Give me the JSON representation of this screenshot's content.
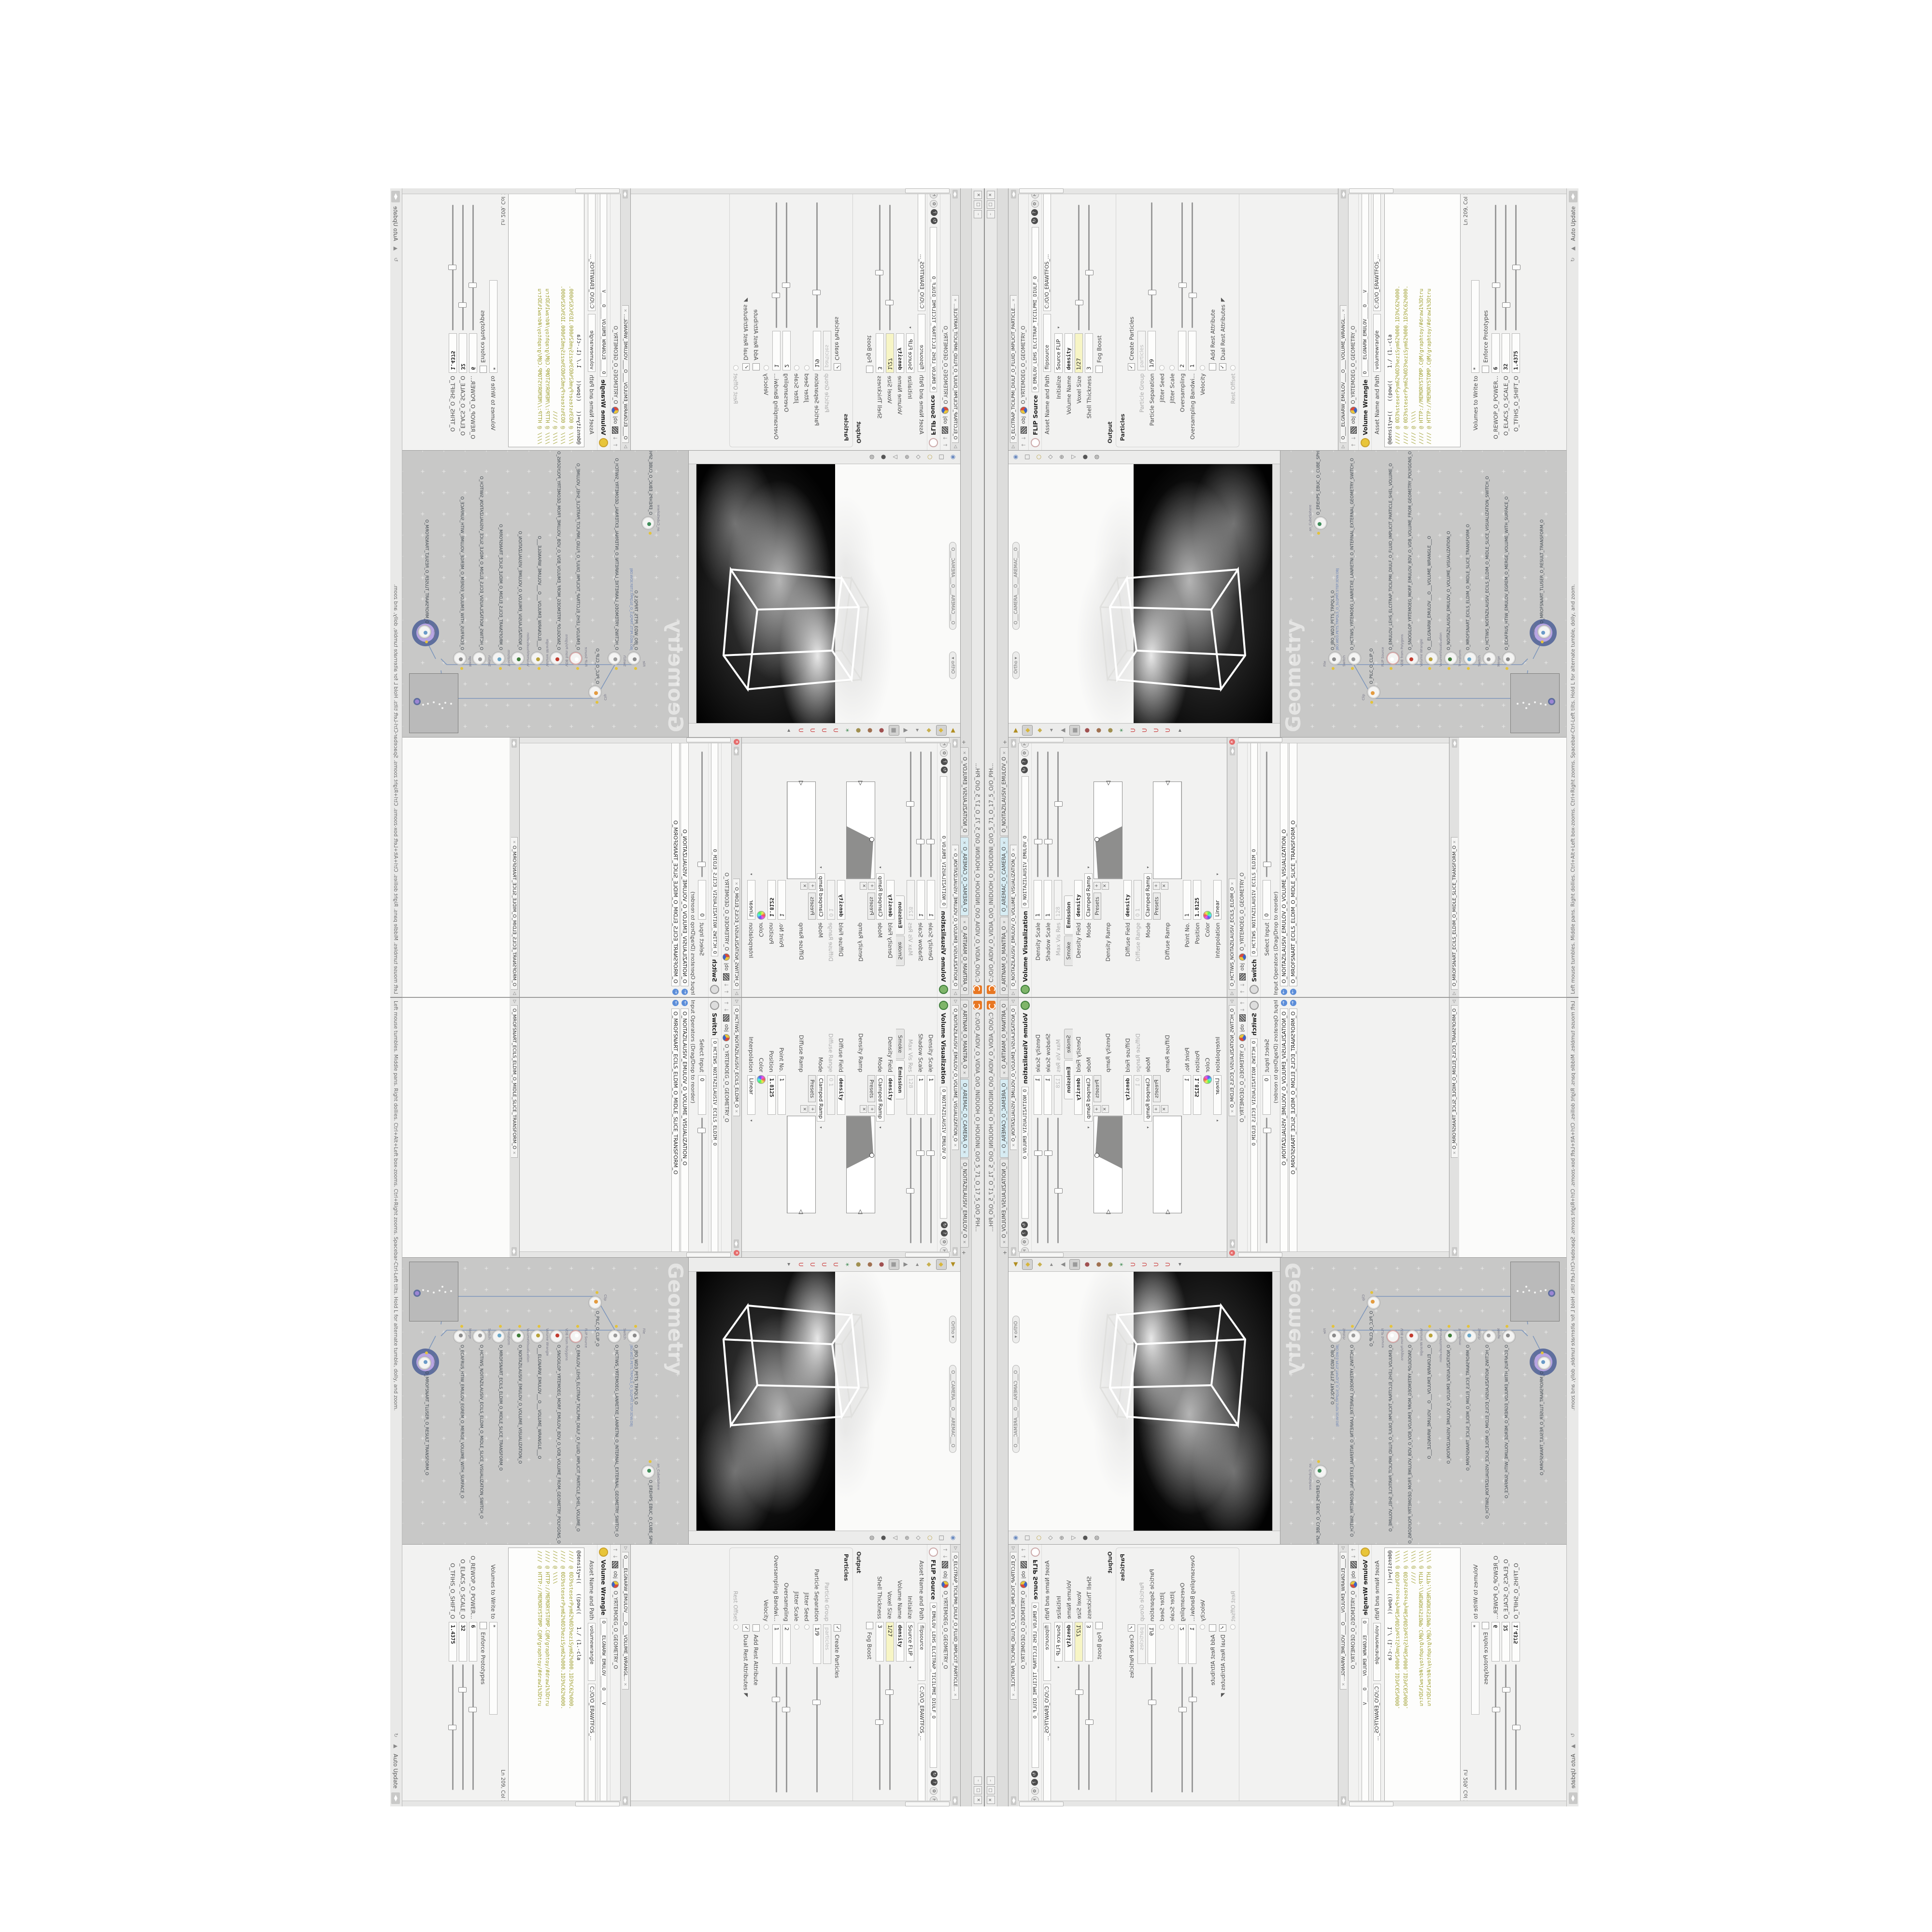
{
  "window": {
    "title": "C:/O/O_AIDIV_O_VIDIA_O/O_INIDUOH_O_HOUDINI_O/O_5_71_O_17_5_O/O_PIH...",
    "logo": "houdini-logo",
    "buttons": [
      "–",
      "□",
      "✕"
    ],
    "tabs": [
      {
        "label": "O_ARTNAM_O_MANTRA_O",
        "active": false
      },
      {
        "label": "O_AREMAC_O_CAMERA_O",
        "active": true
      },
      {
        "label": "O_NOITAZILAUSIV_EMULOV_O",
        "active": false
      }
    ],
    "tab_add": "+",
    "status": {
      "hint": "Left mouse tumbles. Middle pans. Right dollies. Ctrl+Alt+Left box-zooms. Ctrl+Right zooms. Spacebar-Ctrl-Left tilts. Hold L for alternate tumble, dolly, and zoom.",
      "auto_update": "Auto Update"
    }
  },
  "colors": {
    "accent_orange": "#e87722",
    "yellow_field": "#f7f5c5",
    "active_tab_cyan": "#d7ecf3",
    "selection_halo_outer": "#5f6f9e",
    "selection_halo_inner": "#b9a5e3",
    "wire_blue": "#7d96bb",
    "network_bg": "#c8c8c7",
    "code_comment_olive": "#a0a032",
    "code_keyword_blue": "#3a6fae"
  },
  "panes": {
    "flip": {
      "tab": "O_ELCITRAP_TICILPMI_DIULF_O_FLUID_IMPLICIT_PARTICLE...",
      "title": "FLIP Source",
      "name": "O_EMULOV_LEHS_ELCITRAP_TICILPMI_DIULF_O",
      "crumb_root": "obj",
      "crumb_path": "O_YRTEMOEG_O_GEOMETRY_O",
      "asset_label": "Asset Name and Path",
      "asset_value": "flipsource",
      "asset_path": "C:/O/O_ERAWTFOS_...",
      "rows": [
        {
          "type": "menu",
          "label": "Initialize",
          "value": "Source FLIP"
        },
        {
          "type": "field",
          "label": "Volume Name",
          "value": "density",
          "mono": true
        },
        {
          "type": "slider",
          "label": "Voxel Size",
          "value": "1/27",
          "yellow": true,
          "pos": 20
        },
        {
          "type": "slider",
          "label": "Shell Thickness",
          "value": "3",
          "pos": 44
        },
        {
          "type": "check",
          "label": "Fog Boost",
          "checked": false
        },
        {
          "type": "heading",
          "label": "Output"
        },
        {
          "type": "group",
          "label": "Particles",
          "rows": [
            {
              "type": "check",
              "label": "Create Particles",
              "checked": true
            },
            {
              "type": "field",
              "label": "Particle Group",
              "value": "particles",
              "disabled": true
            },
            {
              "type": "slider",
              "label": "Particle Separation",
              "value": "1/9",
              "pos": 26
            },
            {
              "type": "dot",
              "label": "Jitter Seed"
            },
            {
              "type": "dot",
              "label": "Jitter Scale"
            },
            {
              "type": "slider",
              "label": "Oversampling",
              "value": "2",
              "pos": 32
            },
            {
              "type": "slider",
              "label": "Oversampling Bandwi...",
              "value": "1",
              "pos": 24
            },
            {
              "type": "dot",
              "label": "Velocity"
            },
            {
              "type": "check",
              "label": "Add Rest Attribute",
              "checked": false
            },
            {
              "type": "check",
              "label": "Dual Rest Attributes",
              "checked": true,
              "cursor": true
            },
            {
              "type": "dot",
              "label": "Rest Offset",
              "disabled": true
            }
          ]
        }
      ]
    },
    "wrangle": {
      "tab": "O____ELGNARW_EMULOV____O____VOLUME_WRANGL...",
      "title": "Volume Wrangle",
      "name": "O____ELGNARW_EMULOV____O____V",
      "crumb_root": "obj",
      "crumb_path": "O_YRTEMOEG_O_GEOMETRY_O",
      "asset_label": "Asset Name and Path",
      "asset_value": "volumewrangle",
      "asset_path": "C:/O/O_ERAWTFOS_...",
      "code": [
        {
          "cls": "cl-code",
          "text": "@density=((   ((pow((    1./ (1.-cla"
        },
        {
          "cls": "cl-comment",
          "text": "//// @ 0D3%steserPym62%0D3%eziSym62%000.1D3%C62%000."
        },
        {
          "cls": "cl-comment",
          "text": "//// @ 0D3%steserPym62%0D3%eziSym62%000.1D3%C62%000."
        },
        {
          "cls": "cl-comment",
          "text": "//// @ \\\\\\\\"
        },
        {
          "cls": "cl-comment",
          "text": "//// @ HTTP://MEMORYSTOMP.C@M/graphtoy/#draw1%3Dtru"
        },
        {
          "cls": "cl-comment",
          "text": "//// @ HTTP://MEMORYSTOMP.C@M/graphtoy/#draw1%3Dtru"
        }
      ],
      "code_status": "Ln 209, Col 1",
      "rows": [
        {
          "type": "field",
          "label": "Volumes to Write to",
          "value": "*",
          "wide": true
        },
        {
          "type": "check",
          "label": "Enforce Prototypes",
          "checked": false
        },
        {
          "type": "slider",
          "label": "O_REWOP_O_POWER...",
          "value": "6",
          "pos": 34,
          "mono": true
        },
        {
          "type": "slider",
          "label": "O_ELACS_O_SCALE_O",
          "value": "32",
          "pos": 18,
          "mono": true
        },
        {
          "type": "slider",
          "label": "O_TFIHS_O_SHIFT_O",
          "value": "1.4375",
          "pos": 48,
          "mono": true
        }
      ]
    },
    "volvis": {
      "tab": "O_NOITAZILAUSIV_EMULOV_O_VOLUME_VISUALIZATION_O",
      "title": "Volume Visualization",
      "name": "O_NOITAZILAUSIV_EMULOV_O",
      "rows": [
        {
          "type": "slider",
          "label": "Density Scale",
          "value": "1",
          "pos": 26
        },
        {
          "type": "slider",
          "label": "Shadow Scale",
          "value": "1",
          "pos": 26
        },
        {
          "type": "slider",
          "label": "Max Vis Res",
          "value": "128",
          "pos": 56,
          "disabled": true
        },
        {
          "type": "tabs",
          "tabs": [
            "Smoke",
            "Emission"
          ],
          "active": 1
        },
        {
          "type": "field",
          "label": "Density Field",
          "value": "density",
          "mono": true
        },
        {
          "type": "menu",
          "label": "Mode",
          "value": "Clamped Ramp"
        },
        {
          "type": "ramp",
          "label": "Density Ramp",
          "presets": "Presets",
          "variant": 1
        },
        {
          "type": "field",
          "label": "Diffuse Field",
          "value": "density",
          "mono": true
        },
        {
          "type": "field",
          "label": "Diffuse Range",
          "value": "0   1",
          "disabled": true
        },
        {
          "type": "menu",
          "label": "Mode",
          "value": "Clamped Ramp"
        },
        {
          "type": "ramp",
          "label": "Diffuse Ramp",
          "presets": "Presets",
          "variant": 2
        },
        {
          "type": "field",
          "label": "Point No.",
          "value": "1"
        },
        {
          "type": "field",
          "label": "Position",
          "value": "1.8125",
          "mono": true
        },
        {
          "type": "swatch",
          "label": "Color"
        },
        {
          "type": "menu",
          "label": "Interpolation",
          "value": "Linear"
        }
      ]
    },
    "switch": {
      "tab": "O_HCTIWS_NOITAZILAUSIV_ECILS_ELDIM_O",
      "title": "Switch",
      "name": "O_HCTIWS_NOITAZILAUSIV_ECILS_ELDIM_O",
      "crumb_root": "obj",
      "crumb_path": "O_YRTEMOEG_O_GEOMETRY_O",
      "rows": [
        {
          "type": "slider",
          "label": "Select Input",
          "value": "0",
          "pos": 8
        },
        {
          "type": "list",
          "label": "Input Operators (Drag/Drop to reorder)",
          "items": [
            "O_NOITAZILAUSIV_EMULOV_O_VOLUME_VISUALIZATION_O",
            "O_MROFSNART_ECILS_ELDIM_O_MIDLE_SLICE_TRANSFORM_O"
          ]
        }
      ]
    },
    "transform": {
      "tab": "O_MROFSNART_ECILS_ELDIM_O_MIDLE_SLICE_TRANSFORM_O"
    },
    "viewport": {
      "camera_pill": "O___CAMERA___O___AREMAC___O",
      "view_pill": "Ortho ▾",
      "left_toolbar": [
        {
          "g": "▶",
          "c": "#b08d20",
          "n": "select-arrow-icon"
        },
        {
          "g": "◆",
          "c": "#d8b63a",
          "n": "secure-selection-icon",
          "sel": true
        },
        {
          "g": "◆",
          "c": "#c8b050",
          "n": "select-geometry-icon"
        },
        {
          "g": "◂",
          "c": "#8a8a8a",
          "n": "back-icon"
        },
        {
          "g": "▲",
          "c": "#8a8a8a",
          "n": "handles-icon"
        },
        {
          "g": "■",
          "c": "#9a9a9a",
          "n": "view-tool-icon",
          "sel": true
        },
        {
          "g": "●",
          "c": "#a05050",
          "n": "move-tool-icon"
        },
        {
          "g": "●",
          "c": "#a07050",
          "n": "rotate-tool-icon"
        },
        {
          "g": "●",
          "c": "#a09050",
          "n": "scale-tool-icon"
        },
        {
          "g": "✶",
          "c": "#5a9a6a",
          "n": "pose-tool-icon"
        },
        {
          "g": "U",
          "c": "#c44",
          "n": "snap-grid-magnet-icon"
        },
        {
          "g": "U",
          "c": "#c44",
          "n": "snap-point-magnet-icon"
        },
        {
          "g": "U",
          "c": "#c44",
          "n": "snap-edge-magnet-icon"
        },
        {
          "g": "U",
          "c": "#c44",
          "n": "snap-multi-magnet-icon"
        },
        {
          "g": "▸",
          "c": "#777",
          "n": "expand-toolbar-icon"
        }
      ],
      "right_toolbar": [
        {
          "g": "◉",
          "c": "#6a8ac0",
          "n": "view-target-icon"
        },
        {
          "g": "□",
          "c": "#777",
          "n": "layout-single-icon"
        },
        {
          "g": "○",
          "c": "#b8a040",
          "n": "shaded-mode-icon"
        },
        {
          "g": "◇",
          "c": "#777",
          "n": "wireframe-mode-icon"
        },
        {
          "g": "⊕",
          "c": "#777",
          "n": "view-pivot-icon"
        },
        {
          "g": "▽",
          "c": "#777",
          "n": "camera-lock-icon"
        },
        {
          "g": "●",
          "c": "#555",
          "n": "lighting-icon"
        },
        {
          "g": "◍",
          "c": "#777",
          "n": "material-preview-icon"
        }
      ]
    },
    "network": {
      "watermark": "Geometry",
      "extra_node": {
        "type_label": "an_CubeSphere",
        "name": "O_EREHPS_EBUC_O_CUBE_SPHERE_O"
      },
      "minimap": true,
      "nodes": [
        {
          "type": "File",
          "name": "O_JBO_WD3_PETS_TRPQLS_O",
          "file": "JBO.WD3.PETS.TRPQLS_O_SLQPRT.STEP.3DW.OBJ",
          "color": "#8a8a8a",
          "flag": true
        },
        {
          "type": "Switch",
          "name": "O_HCTIWS_YRTEMOEG_LANRETXE_LANRETNI_O_INTERNAL_EXTERNAL_GEOMETRY_SWITCH_O",
          "color": "#9a9a9a",
          "flag": true
        },
        {
          "type": "Clip",
          "name": "O_PILC_O_CLIP_O",
          "color": "#e39b40",
          "flag": true
        },
        {
          "type": "FLIP Source",
          "name": "O_EMULOV_LEHS_ELCITRAP_TICILPMI_DIULF_O_FLUID_IMPLICIT_PARTICLE_SHEL_VOLUME_O",
          "color": "#ffffff",
          "ring": true,
          "flag": true
        },
        {
          "type": "VDB from Polygons",
          "name": "O_SNOGILOP_YRTEMOEG_MORF_EMULOV_BDV_O_VDB_VOLUME_FROM_GEOMETRY_POLYGONS_O",
          "color": "#c23b2e",
          "flag": false
        },
        {
          "type": "Volume Wrangle",
          "name": "O___ELGNARW_EMULOV___O___VOLUME_WRANGLE___O",
          "color": "#b9a23a",
          "flag": true
        },
        {
          "type": "VolumeVisualization",
          "name": "O_NOITAZILAUSIV_EMULOV_O_VOLUME_VISUALIZATION_O",
          "color": "#3f7d3a",
          "flag": true
        },
        {
          "type": "Transform",
          "name": "O_MROFSNART_ECILS_ELDIM_O_MIDLE_SLICE_TRANSFORM_O",
          "color": "#6aa7c8",
          "flag": true
        },
        {
          "type": "Switch",
          "name": "O_HCTIWS_NOITAZILAUSIV_ECILS_ELDIM_O_MIDLE_SLICE_VISUALIZATION_SWITCH_O",
          "color": "#9a9a9a",
          "flag": false
        },
        {
          "type": "Merge",
          "name": "O_ECAFRUS_HTIW_EMULOV_EGREM_O_MERGE_VOLUME_WITH_SURFACE_O",
          "color": "#8a8a8a",
          "flag": true
        },
        {
          "type": "Transform",
          "name": "O_MROFSNART_TLUSER_O_RESULT_TRANSFORM_O",
          "color": "#6a9ac8",
          "selected": true,
          "flag": true
        }
      ]
    }
  }
}
